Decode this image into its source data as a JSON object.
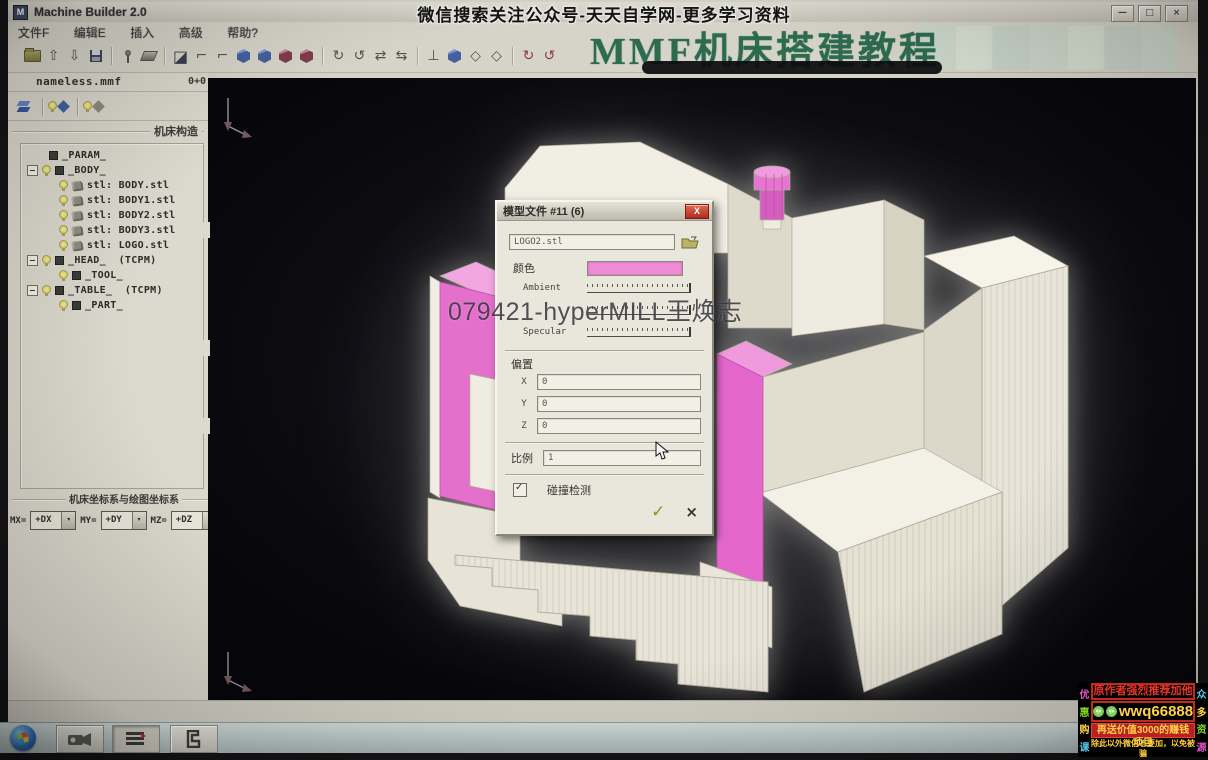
{
  "banner": {
    "text": "微信搜索关注公众号-天天自学网-更多学习资料"
  },
  "tutorial_title": "MMF机床搭建教程",
  "watermark": "079421-hyperMILL王焕志",
  "window": {
    "title": "Machine Builder 2.0",
    "menus": [
      "文件F",
      "编辑E",
      "插入",
      "高级",
      "帮助?"
    ],
    "controls": [
      {
        "name": "minimize",
        "glyph": "—"
      },
      {
        "name": "restore",
        "glyph": "□"
      },
      {
        "name": "close",
        "glyph": "×"
      }
    ]
  },
  "file_bar": {
    "name": "nameless.mmf",
    "meta": "0+0"
  },
  "left_panel": {
    "group_title": "机床构造",
    "coords_title": "机床坐标系与绘图坐标系",
    "axis_rows": [
      {
        "label": "MX=",
        "value": "+DX"
      },
      {
        "label": "MY=",
        "value": "+DY"
      },
      {
        "label": "MZ=",
        "value": "+DZ"
      }
    ],
    "tree": {
      "items": [
        {
          "label": "_PARAM_"
        },
        {
          "label": "_BODY_"
        },
        {
          "label": "stl: BODY.stl"
        },
        {
          "label": "stl: BODY1.stl"
        },
        {
          "label": "stl: BODY2.stl"
        },
        {
          "label": "stl: BODY3.stl"
        },
        {
          "label": "stl: LOGO.stl"
        },
        {
          "label": "_HEAD_  (TCPM)"
        },
        {
          "label": "_TOOL_"
        },
        {
          "label": "_TABLE_  (TCPM)"
        },
        {
          "label": "_PART_"
        }
      ]
    }
  },
  "dialog": {
    "title": "模型文件  #11 (6)",
    "close_glyph": "X",
    "file_value": "LOGO2.stl",
    "color_label": "颜色",
    "color_value": "#ee8cd8",
    "slider_labels": [
      "Ambient",
      "",
      "Specular"
    ],
    "offset_label": "偏置",
    "offset_rows": [
      {
        "label": "X",
        "value": "0"
      },
      {
        "label": "Y",
        "value": "0"
      },
      {
        "label": "Z",
        "value": "0"
      }
    ],
    "scale_label": "比例",
    "scale_value": "1",
    "collision_label": "碰撞检测",
    "ok_glyph": "✓",
    "cancel_glyph": "×"
  },
  "ad": {
    "line1": "原作者强烈推荐加他",
    "wechat_id": "wwq66888",
    "line3": "再送价值3000的赚钱项目",
    "line4": "除此以外微信不要加，以免被骗",
    "left_vertical": [
      "优",
      "惠",
      "购",
      "课"
    ],
    "right_vertical": [
      "众",
      "多",
      "资",
      "源"
    ]
  },
  "colors": {
    "model_pink": "#e468cc",
    "title_green": "#2d6b50"
  }
}
